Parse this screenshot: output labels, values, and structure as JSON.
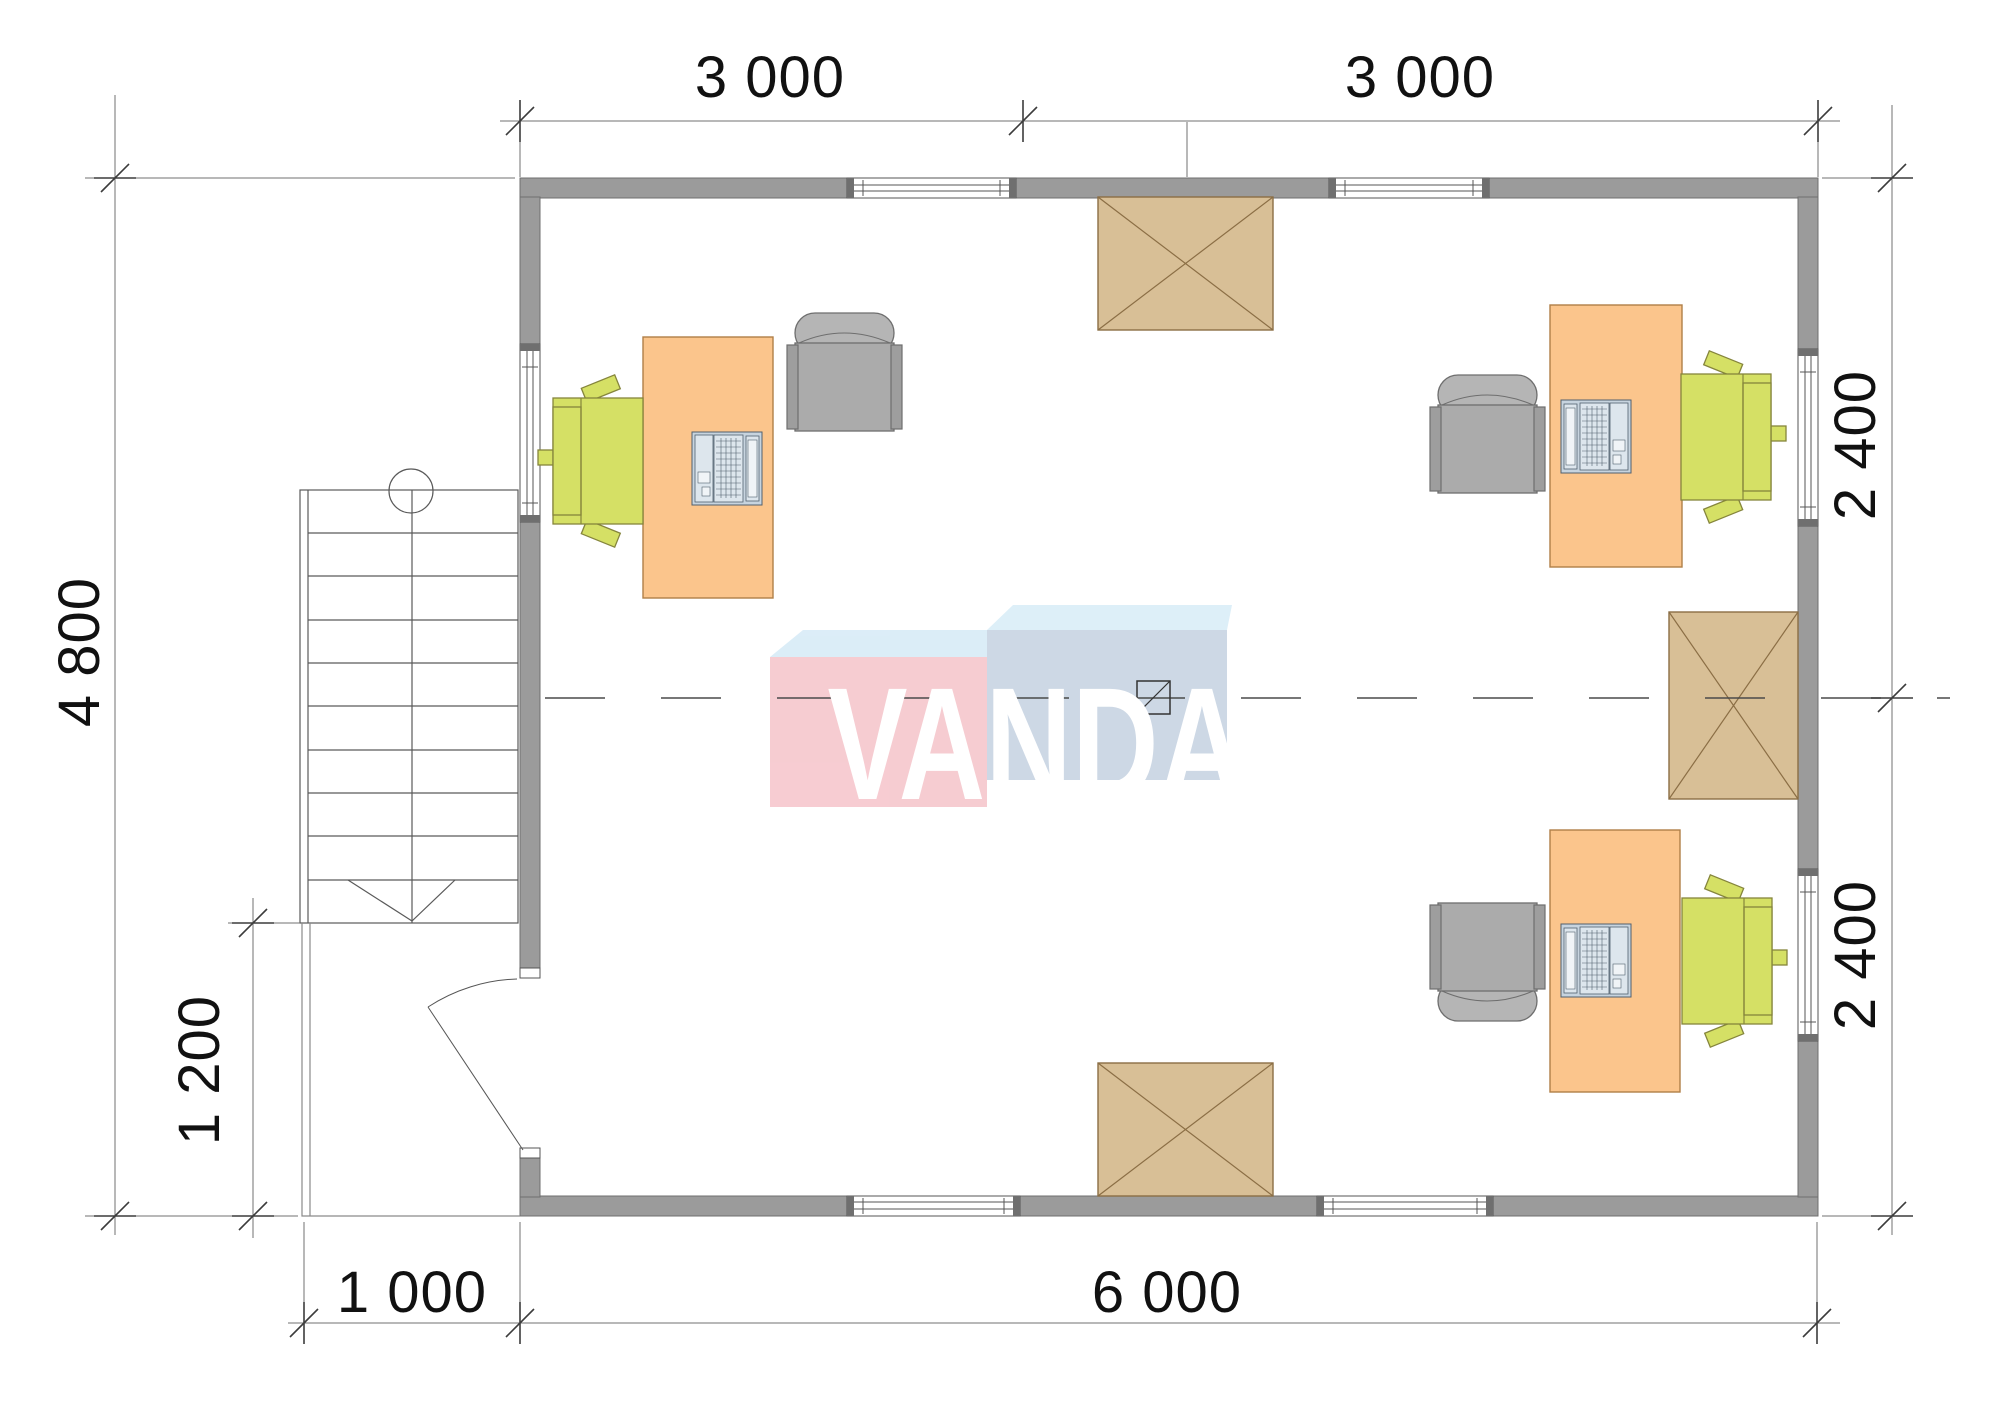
{
  "drawing": {
    "kind": "office floor plan, top view",
    "watermark": {
      "text": "VANDA"
    },
    "dimensions": {
      "top": [
        "3 000",
        "3 000"
      ],
      "right": [
        "2 400",
        "2 400"
      ],
      "bottom": [
        "1 000",
        "6 000"
      ],
      "left": [
        "4 800",
        "1 200"
      ]
    },
    "elements": {
      "workstations": 3,
      "desks": 3,
      "laptops": 3,
      "green_task_chairs": 3,
      "gray_armchairs": 3,
      "hatched_boxes": 3,
      "windows": 7,
      "doors": 1,
      "staircase_steps": 10
    }
  },
  "colors": {
    "wall": "#9b9b9b",
    "wall_outline": "#6f6f6f",
    "thin_line": "#555555",
    "dim_line": "#707070",
    "dim_text": "#111111",
    "desk": "#fbc58c",
    "desk_outline": "#b07f48",
    "chair_green": "#d5e065",
    "chair_green_outline": "#85853c",
    "armchair": "#ababab",
    "armchair_light": "#b5b5b5",
    "armchair_outline": "#6e6e6e",
    "hatch_box": "#d8bf96",
    "hatch_box_outline": "#8b6e45",
    "laptop": "#c7d4df",
    "laptop_outline": "#51606e",
    "logo_pink": "#f6c8ce",
    "logo_blue": "#c9d5e3",
    "logo_flap_left": "#d9ecf7",
    "logo_flap_right": "#dbeef8",
    "logo_text": "#ffffff"
  }
}
